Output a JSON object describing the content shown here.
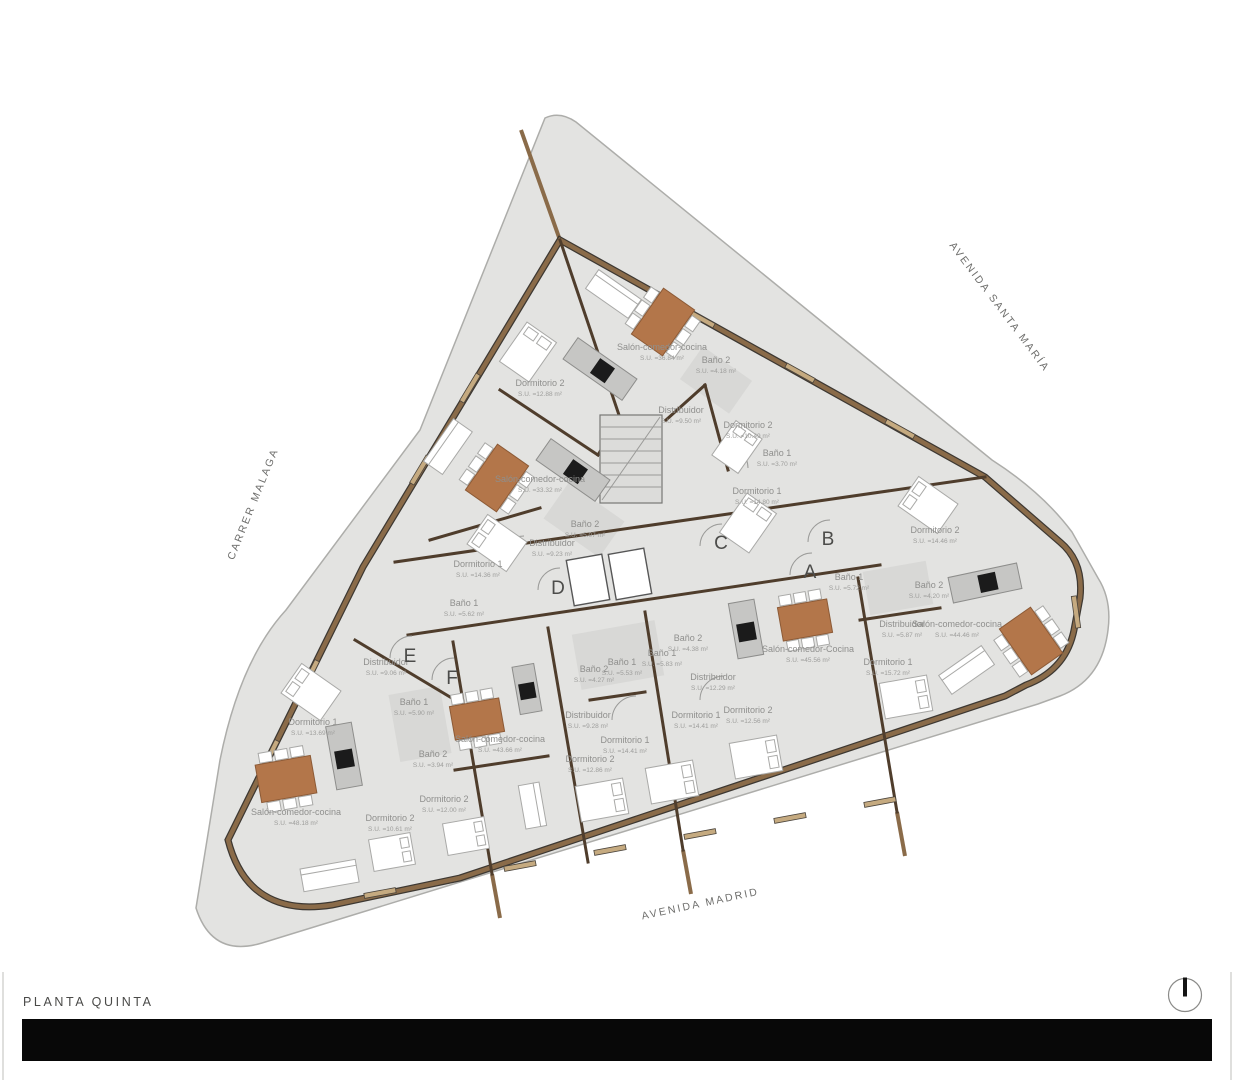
{
  "title": "PLANTA QUINTA",
  "streets": {
    "left": "CARRER MALAGA",
    "right": "AVENIDA SANTA MARÍA",
    "bottom": "AVENIDA MADRID"
  },
  "cores": {
    "a": "A",
    "b": "B",
    "c": "C",
    "d": "D",
    "e": "E",
    "f": "F"
  },
  "colors": {
    "plot": "#e3e3e1",
    "floor": "#eaeae8",
    "wall_brown": "#8a6b49",
    "wall_dark": "#3d3832",
    "table": "#b3764a",
    "kitchen_counter": "#c6c6c4",
    "appliance_black": "#1b1b1b",
    "title_bar": "#080808"
  },
  "rooms": [
    {
      "name": "Salón-comedor-cocina",
      "area": "S.U. =36.84 m²"
    },
    {
      "name": "Dormitorio 2",
      "area": "S.U. =12.88 m²"
    },
    {
      "name": "Baño 2",
      "area": "S.U. =4.18 m²"
    },
    {
      "name": "Distribuidor",
      "area": "S.U. =9.50 m²"
    },
    {
      "name": "Dormitorio 2",
      "area": "S.U. =10.49 m²"
    },
    {
      "name": "Baño 1",
      "area": "S.U. =3.70 m²"
    },
    {
      "name": "Dormitorio 1",
      "area": "S.U. =14.80 m²"
    },
    {
      "name": "Salón-comedor-cocina",
      "area": "S.U. =33.32 m²"
    },
    {
      "name": "Baño 2",
      "area": "S.U. =5.07 m²"
    },
    {
      "name": "Distribuidor",
      "area": "S.U. =9.23 m²"
    },
    {
      "name": "Dormitorio 1",
      "area": "S.U. =14.36 m²"
    },
    {
      "name": "Baño 1",
      "area": "S.U. =5.62 m²"
    },
    {
      "name": "Dormitorio 2",
      "area": "S.U. =14.46 m²"
    },
    {
      "name": "Baño 1",
      "area": "S.U. =5.72 m²"
    },
    {
      "name": "Baño 2",
      "area": "S.U. =4.20 m²"
    },
    {
      "name": "Distribuidor",
      "area": "S.U. =5.87 m²"
    },
    {
      "name": "Salón-comedor-cocina",
      "area": "S.U. =44.46 m²"
    },
    {
      "name": "Dormitorio 1",
      "area": "S.U. =15.72 m²"
    },
    {
      "name": "Baño 2",
      "area": "S.U. =4.38 m²"
    },
    {
      "name": "Baño 1",
      "area": "S.U. =5.83 m²"
    },
    {
      "name": "Distribuidor",
      "area": "S.U. =12.29 m²"
    },
    {
      "name": "Dormitorio 2",
      "area": "S.U. =12.56 m²"
    },
    {
      "name": "Dormitorio 1",
      "area": "S.U. =14.41 m²"
    },
    {
      "name": "Salón-comedor-Cocina",
      "area": "S.U. =45.56 m²"
    },
    {
      "name": "Baño 1",
      "area": "S.U. =5.53 m²"
    },
    {
      "name": "Baño 2",
      "area": "S.U. =4.27 m²"
    },
    {
      "name": "Distribuidor",
      "area": "S.U. =9.28 m²"
    },
    {
      "name": "Dormitorio 1",
      "area": "S.U. =14.41 m²"
    },
    {
      "name": "Dormitorio 2",
      "area": "S.U. =12.86 m²"
    },
    {
      "name": "Salón-comedor-cocina",
      "area": "S.U. =43.66 m²"
    },
    {
      "name": "Dormitorio 2",
      "area": "S.U. =12.00 m²"
    },
    {
      "name": "Dormitorio 2",
      "area": "S.U. =10.61 m²"
    },
    {
      "name": "Distribuidor",
      "area": "S.U. =9.06 m²"
    },
    {
      "name": "Baño 1",
      "area": "S.U. =5.90 m²"
    },
    {
      "name": "Dormitorio 1",
      "area": "S.U. =13.69 m²"
    },
    {
      "name": "Baño 2",
      "area": "S.U. =3.94 m²"
    },
    {
      "name": "Salón-comedor-cocina",
      "area": "S.U. =48.18 m²"
    }
  ]
}
